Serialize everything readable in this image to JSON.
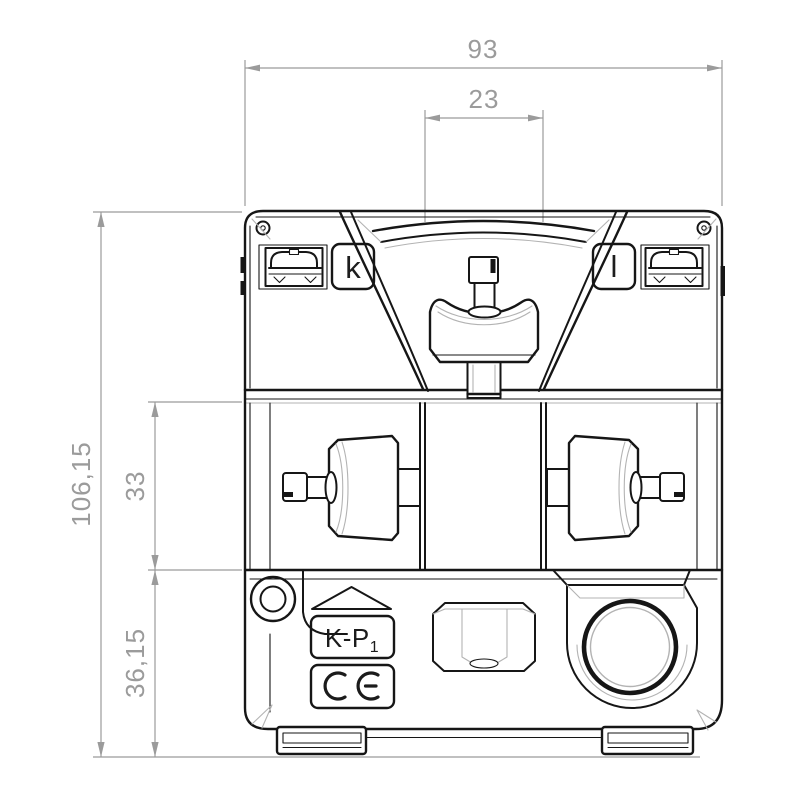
{
  "dimensions": {
    "total_width": "93",
    "window_width": "23",
    "total_height": "106,15",
    "middle_height": "33",
    "bottom_height": "36,15"
  },
  "labels": {
    "terminal_k": "k",
    "terminal_l": "l",
    "marking_prefix": "K-P",
    "marking_sub": "1",
    "ce_mark": "CE"
  },
  "colors": {
    "line": "#161616",
    "dimension": "#9b9b9b",
    "facet": "#b3b3b3",
    "background": "#ffffff"
  }
}
